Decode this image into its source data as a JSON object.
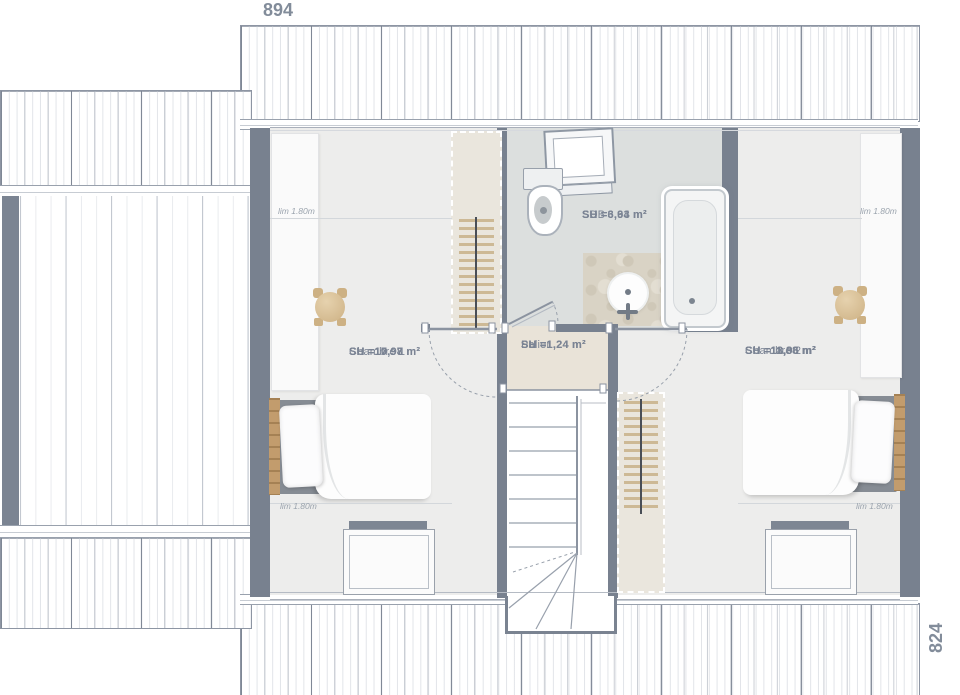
{
  "dimensions": {
    "width_label": "894",
    "height_label": "824"
  },
  "rooms": [
    {
      "name": "Chambre 1",
      "su": "SU =17,97 m²",
      "sh": "SH =10,98 m²"
    },
    {
      "name": "SDB",
      "su": "SU =6,93 m²",
      "sh": "SH =3,64 m²"
    },
    {
      "name": "Palier",
      "su": "SU =1,24 m²",
      "sh": "SH =1,24 m²"
    },
    {
      "name": "Chambre 2",
      "su": "SU =18,96 m²",
      "sh": "SH =11,88 m²"
    }
  ],
  "annotations": {
    "height_limit": "lim 1.80m"
  },
  "colors": {
    "wall": "#78818f",
    "room_floor": "#ededec",
    "bathroom_floor": "#dcdfde",
    "landing_floor": "#e9e3d8",
    "wood": "#c29c6d",
    "hanger_tan": "#cdb995",
    "label_text": "#7b8494",
    "dimension_text": "#828c9a"
  }
}
